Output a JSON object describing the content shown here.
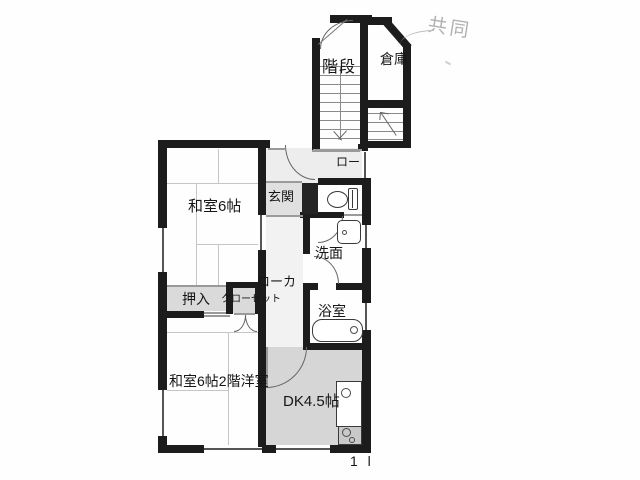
{
  "document": {
    "type": "floor-plan-scan",
    "page_mark": "1 l"
  },
  "annotations": {
    "handwritten_note": "共同"
  },
  "rooms": {
    "stairs": "階段",
    "storage": "倉庫",
    "upper_corridor": "ロー",
    "entrance": "玄関",
    "japanese_room_6": "和室6帖",
    "washroom": "洗面",
    "corridor": "ローカ",
    "oshiire_closet": "押入",
    "closet": "クローゼット",
    "bathroom": "浴室",
    "japanese_room_6_2f_western": "和室6帖2階洋室",
    "dining_kitchen": "DK4.5帖"
  },
  "colors": {
    "wall": "#1c1c1c",
    "paper": "#fefefe",
    "shaded_floor": "#d9d9d9",
    "hall_floor": "#e6e6e6",
    "handwriting": "#b0b0b0"
  },
  "fixtures": {
    "toilet": "toilet-icon",
    "sink": "sink-icon",
    "bathtub": "bathtub-icon",
    "kitchen_sink": "kitchen-sink-icon",
    "stove": "stove-icon",
    "shoe_cabinet": "shoe-cabinet"
  }
}
